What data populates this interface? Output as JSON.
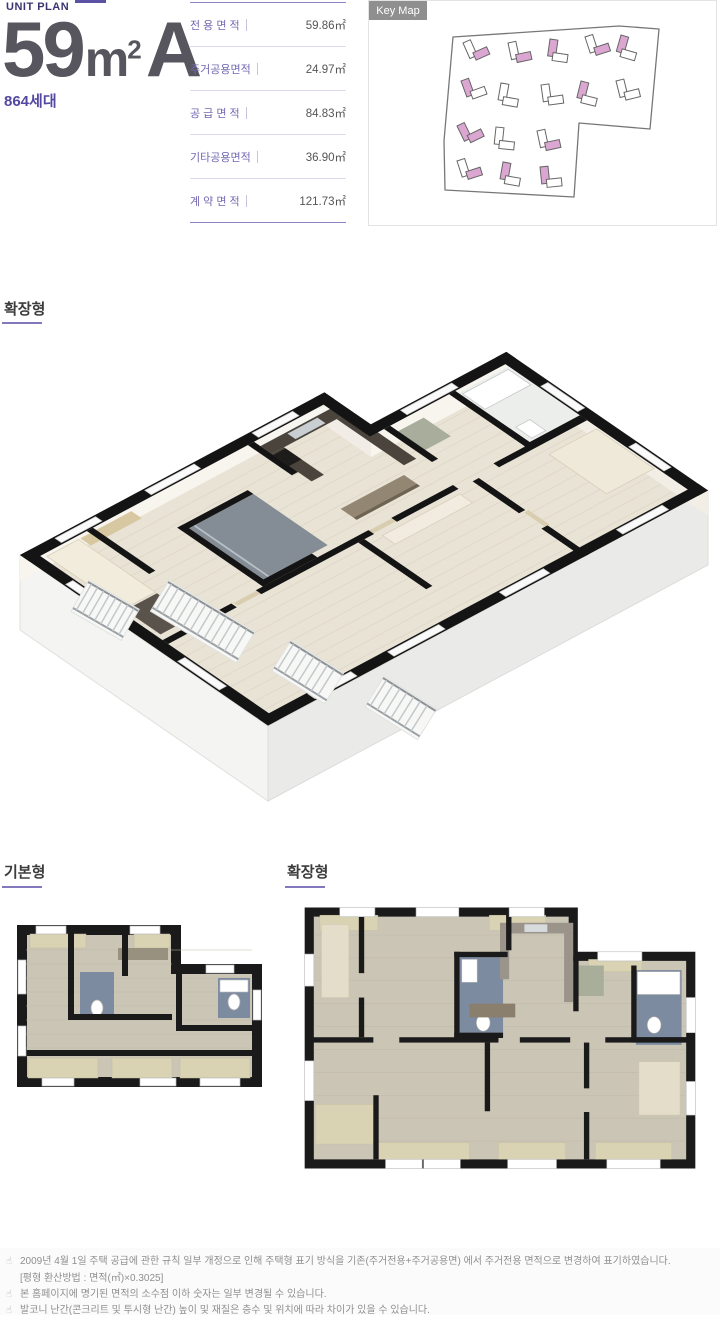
{
  "header": {
    "eyebrow": "UNIT PLAN",
    "title": {
      "num": "59",
      "unit_m": "m",
      "unit_sup": "2",
      "type": "A"
    },
    "households": "864세대",
    "area_table": {
      "rows": [
        {
          "label": "전 용 면 적",
          "value": "59.86㎡"
        },
        {
          "label": "주거공용면적",
          "value": "24.97㎡"
        },
        {
          "label": "공 급 면 적",
          "value": "84.83㎡"
        },
        {
          "label": "기타공용면적",
          "value": "36.90㎡"
        },
        {
          "label": "계 약 면 적",
          "value": "121.73㎡"
        }
      ]
    },
    "keymap": {
      "badge": "Key Map"
    }
  },
  "sections": {
    "iso_label": "확장형",
    "basic_label": "기본형",
    "expanded_label": "확장형"
  },
  "footer": {
    "notes": [
      {
        "icon": "☝",
        "text": "2009년 4월 1일 주택 공급에 관한 규칙 일부 개정으로 인해 주택형 표기 방식을 기존(주거전용+주거공용면) 에서 주거전용 면적으로 변경하여 표기하였습니다."
      },
      {
        "icon": "",
        "text": "[평형 환산방법 : 면적(㎡)×0.3025]"
      },
      {
        "icon": "☝",
        "text": "본 홈페이지에 명기된 면적의 소수점 이하 숫자는 일부 변경될 수 있습니다."
      },
      {
        "icon": "☝",
        "text": "발코니 난간(콘크리트 및 투시형 난간) 높이 및 재질은 층수 및 위치에 따라 차이가 있을 수 있습니다."
      }
    ]
  },
  "colors": {
    "accent_purple": "#5b51a5",
    "label_purple": "#7268b2",
    "keymap_pink": "#d9a6d0",
    "wall_black": "#141414",
    "floor_beige": "#e9e3d6",
    "bath_blue": "#7d8ba0",
    "balcony_tan": "#d9d2b3"
  }
}
